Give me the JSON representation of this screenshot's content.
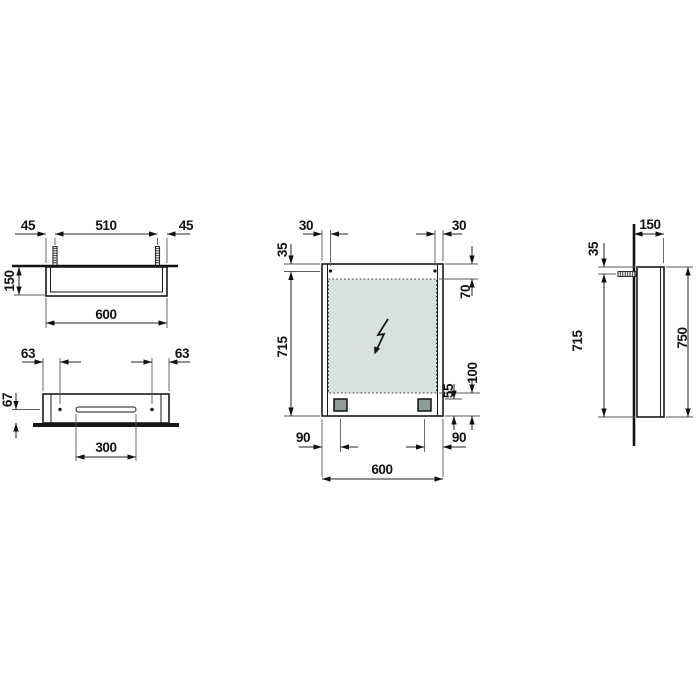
{
  "drawing": {
    "description": "Technical dimension drawing of a wall-mounted mirror cabinet: top view, mounting-bracket view, front view and side view",
    "colors": {
      "line": "#1a1a1a",
      "mirror_glass_fill": "#d8e1df",
      "pad_fill": "#8e9c9a",
      "background": "#ffffff"
    },
    "icons": {
      "lightning_bolt": "electrical-connection",
      "screw_anchor": "wall-fixing-screw"
    },
    "dims": {
      "top_view": {
        "offset_left": "45",
        "hinge_spacing": "510",
        "offset_right": "45",
        "depth": "150",
        "width": "600"
      },
      "bracket_view": {
        "offset_left": "63",
        "offset_right": "63",
        "height": "67",
        "slot_width": "300"
      },
      "front_view": {
        "hole_offset_left": "30",
        "hole_offset_right": "30",
        "top_to_hole": "35",
        "top_to_glass": "70",
        "hole_to_bottom": "715",
        "pad_to_bottom": "55",
        "glass_to_bottom": "100",
        "pad_inset_left": "90",
        "pad_inset_right": "90",
        "width": "600"
      },
      "side_view": {
        "depth": "150",
        "top_to_anchor": "35",
        "anchor_to_bottom": "715",
        "height": "750"
      }
    }
  }
}
